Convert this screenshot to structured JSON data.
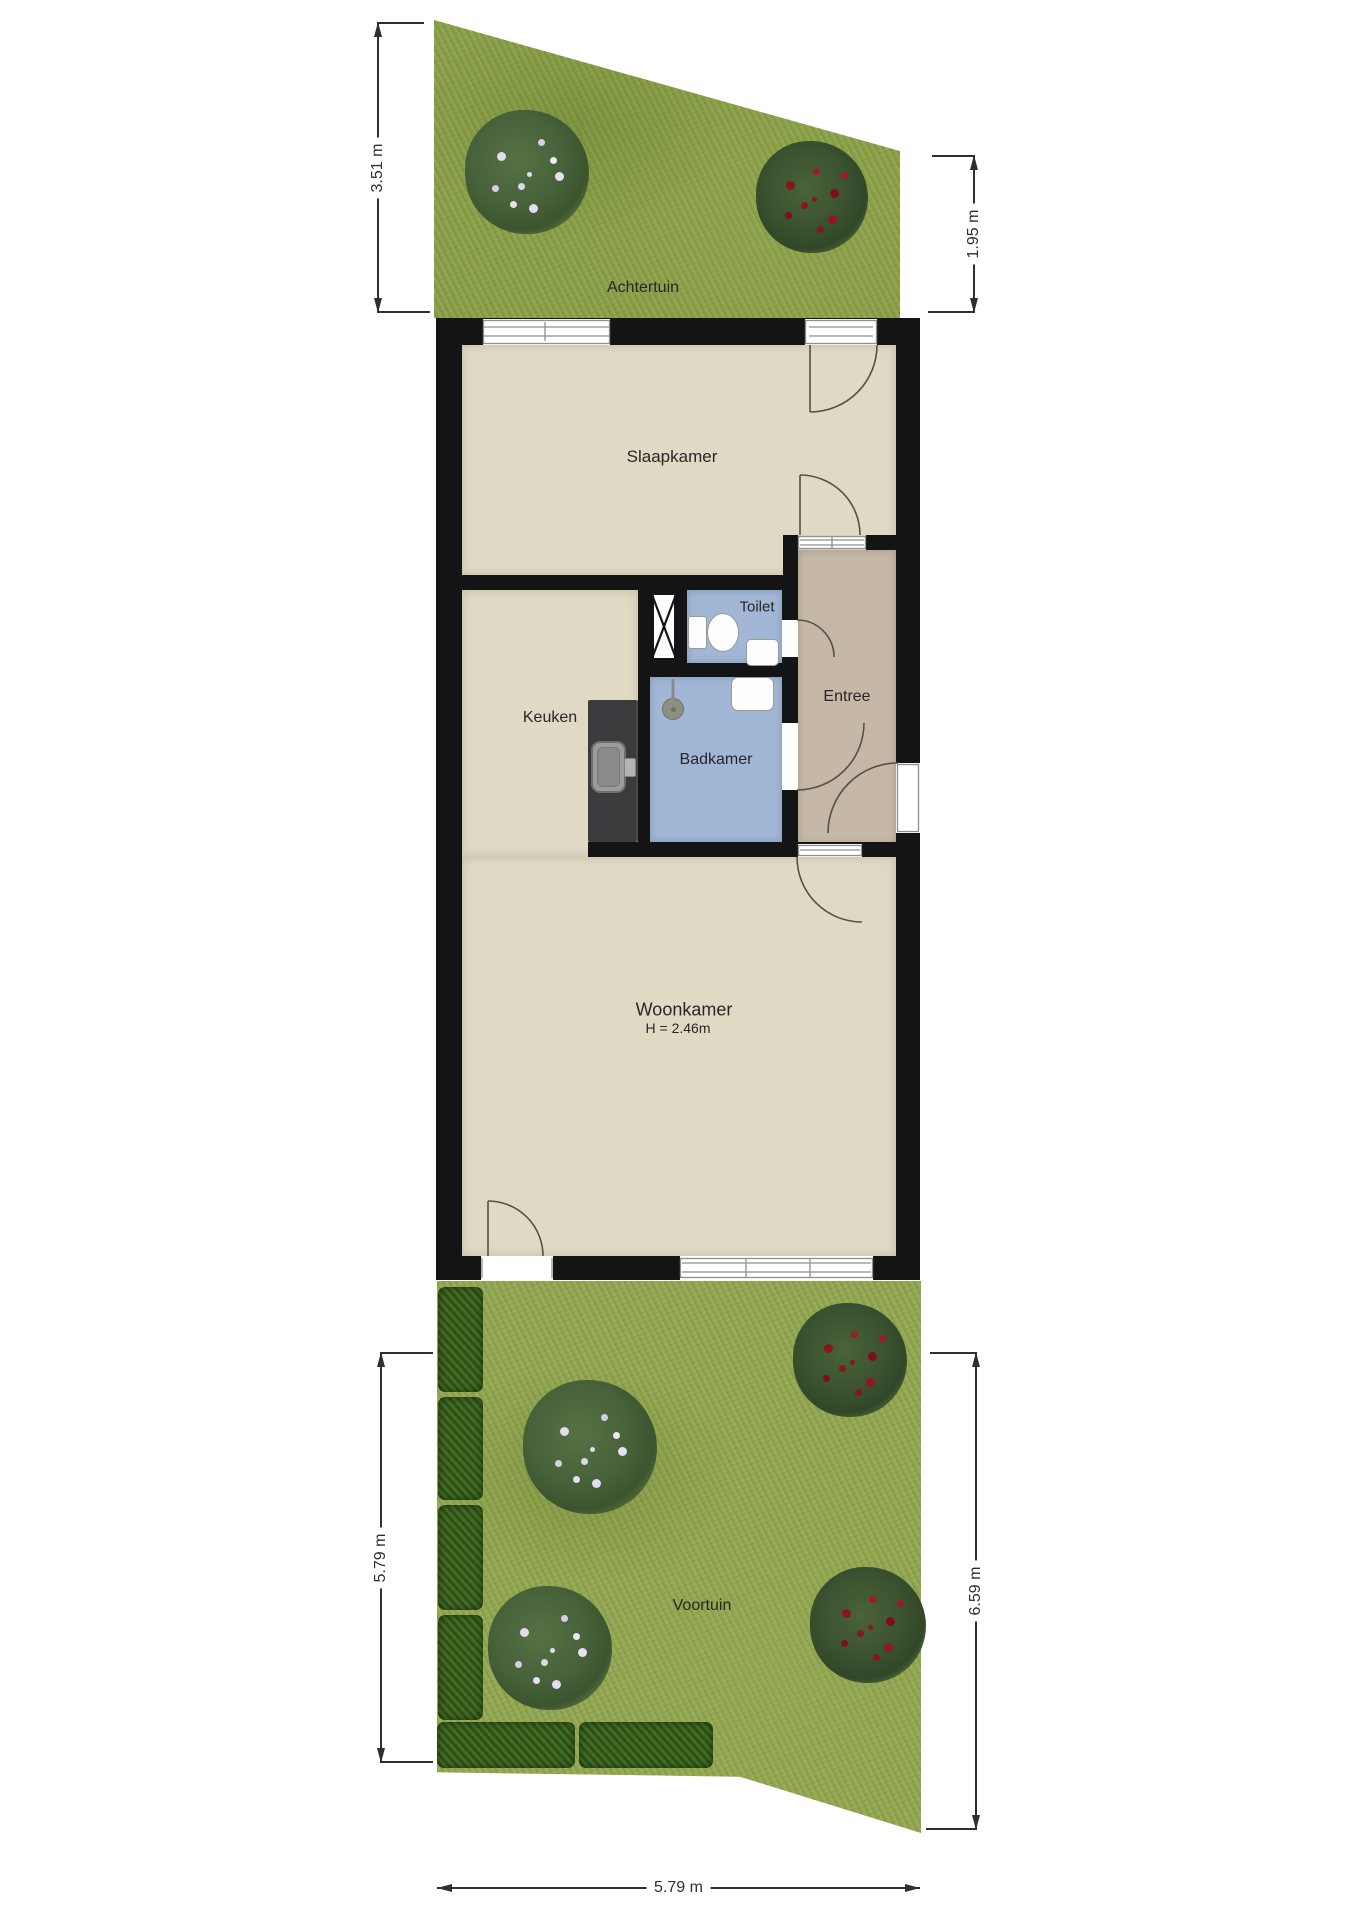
{
  "plan_type": "floor-plan-with-gardens",
  "rooms": {
    "achtertuin": "Achtertuin",
    "slaapkamer": "Slaapkamer",
    "toilet": "Toilet",
    "keuken": "Keuken",
    "badkamer": "Badkamer",
    "entree": "Entree",
    "woonkamer": "Woonkamer",
    "woonkamer_height": "H = 2.46m",
    "voortuin": "Voortuin"
  },
  "dimensions": {
    "achtertuin_left": "3.51 m",
    "achtertuin_right": "1.95 m",
    "voortuin_left": "5.79 m",
    "voortuin_right": "6.59 m",
    "voortuin_bottom": "5.79 m"
  },
  "colors": {
    "wall": "#141414",
    "floor_dry": "#e0dac5",
    "floor_wet": "#a2b7d5",
    "floor_hall": "#c6b8a7",
    "grass_back": "#8ba04e",
    "grass_front": "#97ab5b",
    "hedge": "#3c6224",
    "rose_red": "#8a1420",
    "dimension_line": "#2f2f2f"
  }
}
